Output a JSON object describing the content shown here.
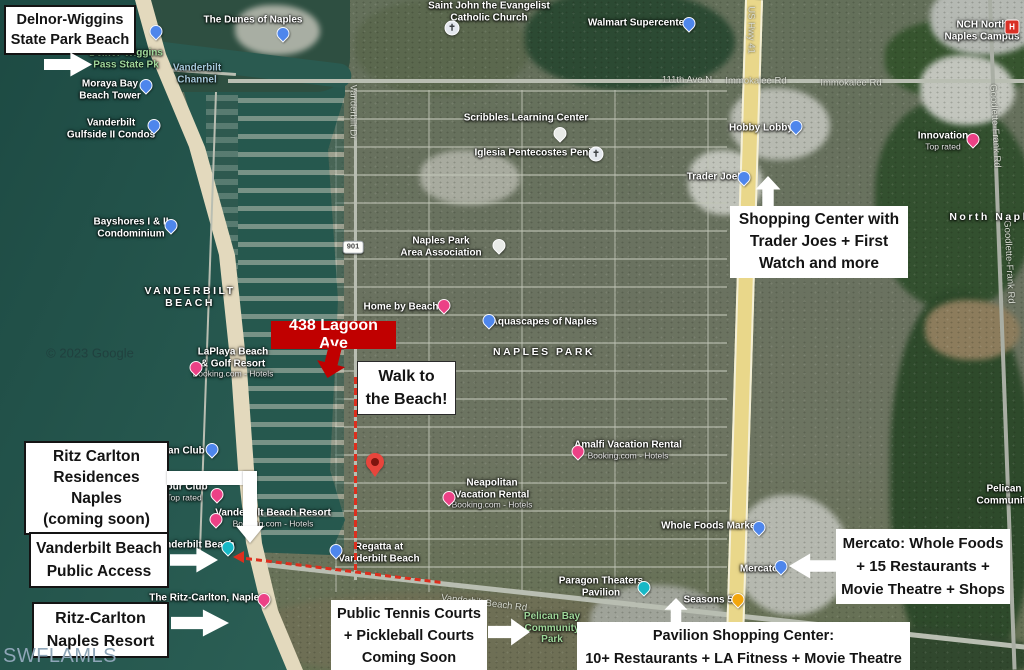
{
  "watermarks": {
    "mls": "SWFLAMLS",
    "google": "© 2023 Google"
  },
  "callouts": {
    "delnor": {
      "lines": [
        "Delnor-Wiggins",
        "State Park Beach"
      ]
    },
    "shopping": {
      "lines": [
        "Shopping Center with",
        "Trader Joes + First",
        "Watch and more"
      ]
    },
    "lagoon": {
      "label": "438 Lagoon Ave"
    },
    "walk": {
      "lines": [
        "Walk to",
        "the Beach!"
      ]
    },
    "ritz_res": {
      "lines": [
        "Ritz Carlton",
        "Residences Naples",
        "(coming soon)"
      ]
    },
    "vb_access": {
      "lines": [
        "Vanderbilt Beach",
        "Public Access"
      ]
    },
    "ritz_resort": {
      "lines": [
        "Ritz-Carlton",
        "Naples Resort"
      ]
    },
    "tennis": {
      "lines": [
        "Public Tennis Courts",
        "+ Pickleball Courts",
        "Coming Soon"
      ]
    },
    "pavilion": {
      "lines": [
        "Pavilion Shopping Center:",
        "10+ Restaurants + LA Fitness + Movie Theatre"
      ]
    },
    "mercato": {
      "lines": [
        "Mercato: Whole Foods",
        "+ 15 Restaurants +",
        "Movie Theatre + Shops"
      ]
    }
  },
  "colors": {
    "callout_red": "#c00000",
    "route_red": "#dd2f1e",
    "highway_yellow": "#e9d78a",
    "water": "#2b5f55",
    "pin_blue": "#4e86ec",
    "pin_pink": "#ec4186",
    "pin_teal": "#16b8c6",
    "pin_orange": "#f2a60d",
    "hospital_red": "#d93025"
  },
  "map": {
    "pois": [
      {
        "lines": [
          "The Dunes of Naples"
        ],
        "x": 253,
        "y": 20,
        "pin": {
          "type": "blue",
          "x": 283,
          "y": 40
        }
      },
      {
        "lines": [
          "Saint John the Evangelist",
          "Catholic Church"
        ],
        "x": 489,
        "y": 12,
        "pin": {
          "type": "church",
          "x": 452,
          "y": 34
        }
      },
      {
        "lines": [
          "Walmart Supercenter"
        ],
        "x": 638,
        "y": 23,
        "pin": {
          "type": "blue",
          "x": 689,
          "y": 30
        }
      },
      {
        "lines": [
          "NCH North",
          "Naples Campus"
        ],
        "x": 982,
        "y": 31,
        "pin": {
          "type": "red-h",
          "x": 1012,
          "y": 33
        }
      },
      {
        "lines": [
          "111th Ave N"
        ],
        "x": 687,
        "y": 81,
        "kind": "road"
      },
      {
        "lines": [
          "Immokalee Rd"
        ],
        "x": 756,
        "y": 82,
        "kind": "road"
      },
      {
        "lines": [
          "Immokalee Rd"
        ],
        "x": 851,
        "y": 84,
        "kind": "road"
      },
      {
        "lines": [
          "US Hwy 41"
        ],
        "x": 750,
        "y": 30,
        "kind": "road",
        "rot": 90
      },
      {
        "lines": [
          "Goodlette-Frank Rd"
        ],
        "x": 994,
        "y": 126,
        "kind": "road",
        "rot": 87
      },
      {
        "lines": [
          "Goodlette-Frank Rd"
        ],
        "x": 1008,
        "y": 262,
        "kind": "road",
        "rot": 87
      },
      {
        "lines": [
          "Vanderbilt Dr"
        ],
        "x": 352,
        "y": 112,
        "kind": "road",
        "rot": 90
      },
      {
        "lines": [
          "Hobby Lobby"
        ],
        "x": 761,
        "y": 128,
        "pin": {
          "type": "blue",
          "x": 796,
          "y": 133
        }
      },
      {
        "lines": [
          "Innovation"
        ],
        "sub": "Top rated",
        "x": 943,
        "y": 141,
        "pin": {
          "type": "pink",
          "x": 973,
          "y": 146
        }
      },
      {
        "lines": [
          "Trader Joe's"
        ],
        "x": 716,
        "y": 177,
        "pin": {
          "type": "blue",
          "x": 744,
          "y": 184
        }
      },
      {
        "lines": [
          "North Naples"
        ],
        "x": 997,
        "y": 217,
        "kind": "district"
      },
      {
        "lines": [
          "Scribbles Learning Center"
        ],
        "x": 526,
        "y": 118,
        "pin": {
          "type": "white",
          "x": 560,
          "y": 140
        }
      },
      {
        "lines": [
          "Iglesia Pentecostes Peniel"
        ],
        "x": 537,
        "y": 153,
        "pin": {
          "type": "church",
          "x": 596,
          "y": 160
        }
      },
      {
        "lines": [
          "Naples Park",
          "Area Association"
        ],
        "x": 441,
        "y": 247,
        "pin": {
          "type": "white",
          "x": 499,
          "y": 252
        }
      },
      {
        "lines": [
          "Home by Beach"
        ],
        "x": 401,
        "y": 307,
        "pin": {
          "type": "pink",
          "x": 444,
          "y": 312
        }
      },
      {
        "lines": [
          "Aquascapes of Naples"
        ],
        "x": 544,
        "y": 322,
        "pin": {
          "type": "blue",
          "x": 489,
          "y": 327
        }
      },
      {
        "lines": [
          "NAPLES PARK"
        ],
        "x": 544,
        "y": 352,
        "kind": "district"
      },
      {
        "lines": [
          "Vanderbilt",
          "Channel"
        ],
        "x": 197,
        "y": 74,
        "kind": "water"
      },
      {
        "lines": [
          "Delnor-Wiggins",
          "Pass State Pk"
        ],
        "x": 126,
        "y": 59,
        "kind": "park",
        "pin": {
          "type": "blue",
          "x": 156,
          "y": 38
        }
      },
      {
        "lines": [
          "Moraya Bay",
          "Beach Tower"
        ],
        "x": 110,
        "y": 90,
        "pin": {
          "type": "blue",
          "x": 146,
          "y": 92
        }
      },
      {
        "lines": [
          "Vanderbilt",
          "Gulfside II Condos"
        ],
        "x": 111,
        "y": 129,
        "pin": {
          "type": "blue",
          "x": 154,
          "y": 132
        }
      },
      {
        "lines": [
          "Bayshores I & II",
          "Condominium"
        ],
        "x": 131,
        "y": 228,
        "pin": {
          "type": "blue",
          "x": 171,
          "y": 232
        }
      },
      {
        "lines": [
          "VANDERBILT",
          "BEACH"
        ],
        "x": 190,
        "y": 297,
        "kind": "district"
      },
      {
        "lines": [
          "LaPlaya Beach",
          "& Golf Resort"
        ],
        "sub": "Booking.com - Hotels",
        "x": 233,
        "y": 363,
        "pin": {
          "type": "pink",
          "x": 196,
          "y": 374
        }
      },
      {
        "lines": [
          "ian Club"
        ],
        "x": 185,
        "y": 451,
        "pin": {
          "type": "blue",
          "x": 212,
          "y": 456
        }
      },
      {
        "lines": [
          "bour Club"
        ],
        "sub": "Top rated",
        "x": 184,
        "y": 492,
        "pin": {
          "type": "pink",
          "x": 217,
          "y": 501
        }
      },
      {
        "lines": [
          "Vanderbilt Beach Resort"
        ],
        "sub": "Booking.com - Hotels",
        "x": 273,
        "y": 518,
        "pin": {
          "type": "pink",
          "x": 216,
          "y": 526
        }
      },
      {
        "lines": [
          "Vanderbilt Beach"
        ],
        "x": 194,
        "y": 545,
        "pin": {
          "type": "teal",
          "x": 228,
          "y": 554
        }
      },
      {
        "lines": [
          "Regatta at",
          "Vanderbilt Beach"
        ],
        "x": 379,
        "y": 553,
        "pin": {
          "type": "blue",
          "x": 336,
          "y": 557
        }
      },
      {
        "lines": [
          "The Ritz-Carlton, Naples"
        ],
        "x": 207,
        "y": 598,
        "pin": {
          "type": "pink",
          "x": 264,
          "y": 606
        }
      },
      {
        "lines": [
          "Amalfi Vacation Rental"
        ],
        "sub": "Booking.com - Hotels",
        "x": 628,
        "y": 450,
        "pin": {
          "type": "pink",
          "x": 578,
          "y": 458
        }
      },
      {
        "lines": [
          "Neapolitan",
          "Vacation Rental"
        ],
        "sub": "Booking.com - Hotels",
        "x": 492,
        "y": 494,
        "pin": {
          "type": "pink",
          "x": 449,
          "y": 504
        }
      },
      {
        "lines": [
          "Whole Foods Market"
        ],
        "x": 710,
        "y": 526,
        "pin": {
          "type": "blue",
          "x": 759,
          "y": 534
        }
      },
      {
        "lines": [
          "Mercato"
        ],
        "x": 759,
        "y": 569,
        "pin": {
          "type": "blue",
          "x": 781,
          "y": 573
        }
      },
      {
        "lines": [
          "Seasons 52"
        ],
        "x": 711,
        "y": 600,
        "pin": {
          "type": "orange",
          "x": 738,
          "y": 606
        }
      },
      {
        "lines": [
          "Paragon Theaters",
          "Pavilion"
        ],
        "x": 601,
        "y": 587,
        "pin": {
          "type": "teal",
          "x": 644,
          "y": 594
        }
      },
      {
        "lines": [
          "Pelican Bay",
          "Community",
          "Park"
        ],
        "x": 552,
        "y": 628,
        "kind": "park"
      },
      {
        "lines": [
          "Vanderbilt Beach Rd"
        ],
        "x": 484,
        "y": 604,
        "kind": "road",
        "rot": 7
      },
      {
        "lines": [
          "Pelican",
          "Community"
        ],
        "x": 1004,
        "y": 495
      },
      {
        "lines": [
          "901"
        ],
        "x": 353,
        "y": 247,
        "kind": "shield"
      }
    ]
  }
}
